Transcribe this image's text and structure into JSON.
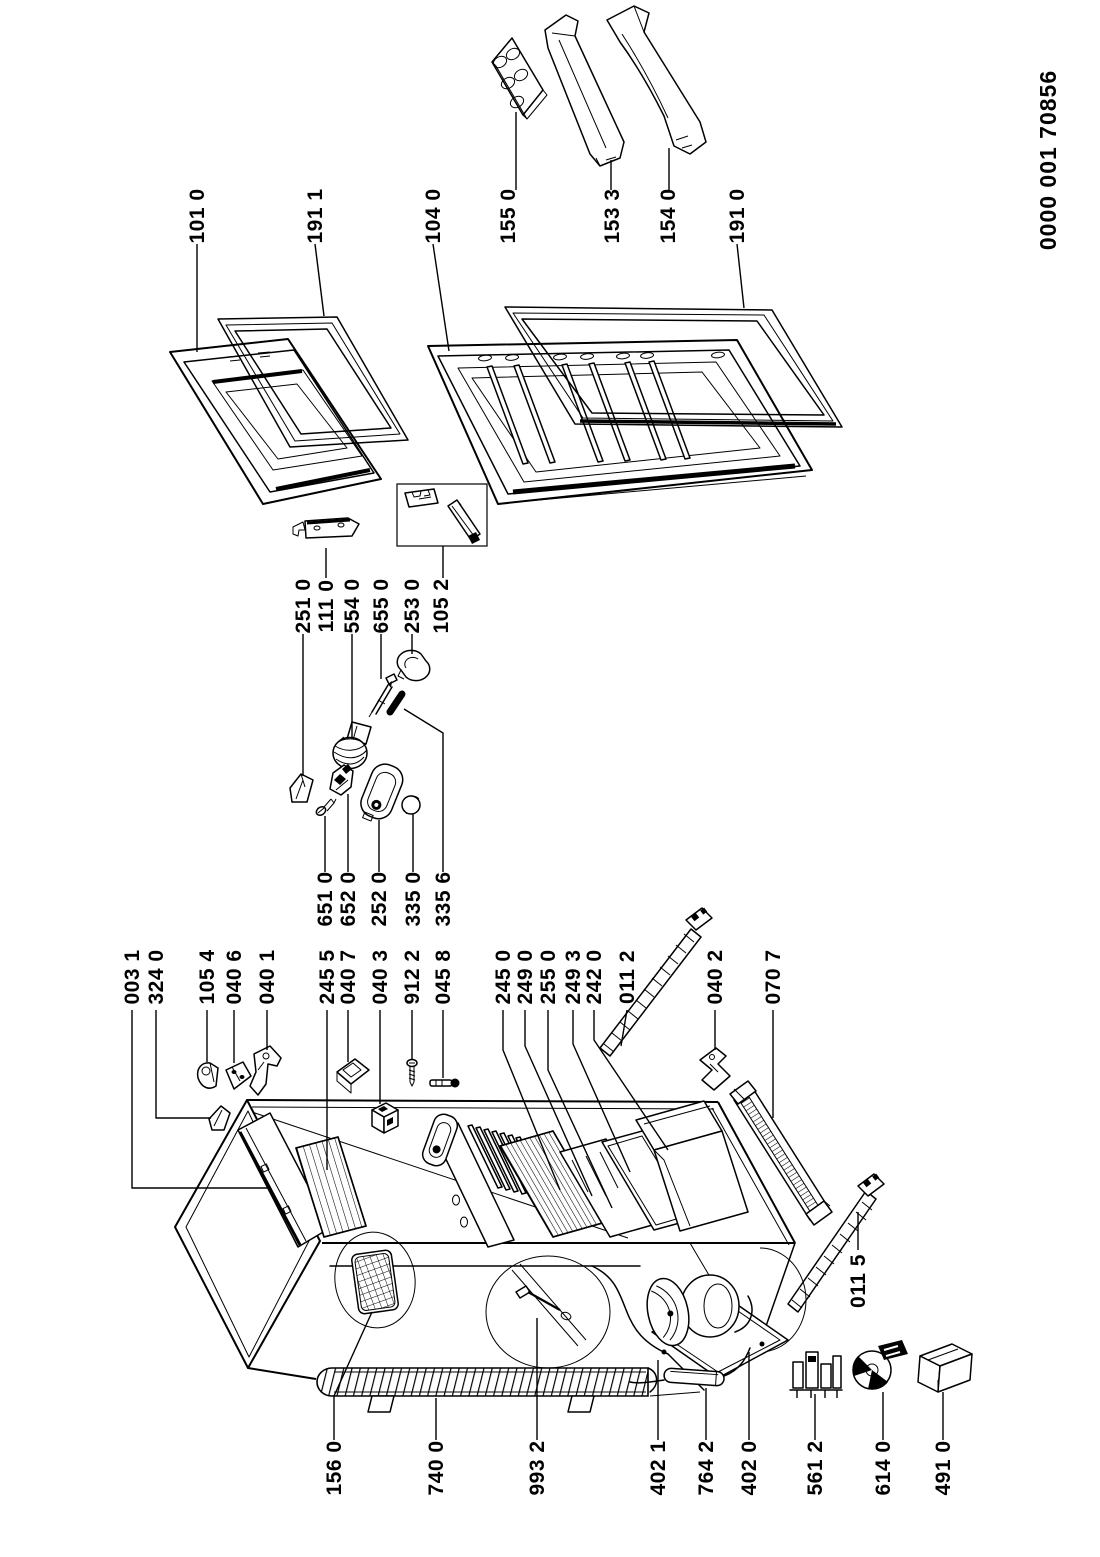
{
  "page": {
    "background": "#ffffff",
    "ink": "#000000",
    "kind": "exploded parts diagram (refrigerator)"
  },
  "document": {
    "number": "0000 001 70856"
  },
  "labels": [
    {
      "text": "101 0"
    },
    {
      "text": "191 1"
    },
    {
      "text": "104 0"
    },
    {
      "text": "155 0"
    },
    {
      "text": "153 3"
    },
    {
      "text": "154 0"
    },
    {
      "text": "191 0"
    },
    {
      "text": "251 0"
    },
    {
      "text": "111 0"
    },
    {
      "text": "554 0"
    },
    {
      "text": "655 0"
    },
    {
      "text": "253 0"
    },
    {
      "text": "105 2"
    },
    {
      "text": "651 0"
    },
    {
      "text": "652 0"
    },
    {
      "text": "252 0"
    },
    {
      "text": "335 0"
    },
    {
      "text": "335 6"
    },
    {
      "text": "003 1"
    },
    {
      "text": "324 0"
    },
    {
      "text": "105 4"
    },
    {
      "text": "040 6"
    },
    {
      "text": "040 1"
    },
    {
      "text": "245 5"
    },
    {
      "text": "040 7"
    },
    {
      "text": "040 3"
    },
    {
      "text": "912 2"
    },
    {
      "text": "045 8"
    },
    {
      "text": "245 0"
    },
    {
      "text": "249 0"
    },
    {
      "text": "255 0"
    },
    {
      "text": "249 3"
    },
    {
      "text": "242 0"
    },
    {
      "text": "011 2"
    },
    {
      "text": "040 2"
    },
    {
      "text": "070 7"
    },
    {
      "text": "011 5"
    },
    {
      "text": "156 0"
    },
    {
      "text": "740 0"
    },
    {
      "text": "993 2"
    },
    {
      "text": "402 1"
    },
    {
      "text": "764 2"
    },
    {
      "text": "402 0"
    },
    {
      "text": "561 2"
    },
    {
      "text": "614 0"
    },
    {
      "text": "491 0"
    }
  ]
}
